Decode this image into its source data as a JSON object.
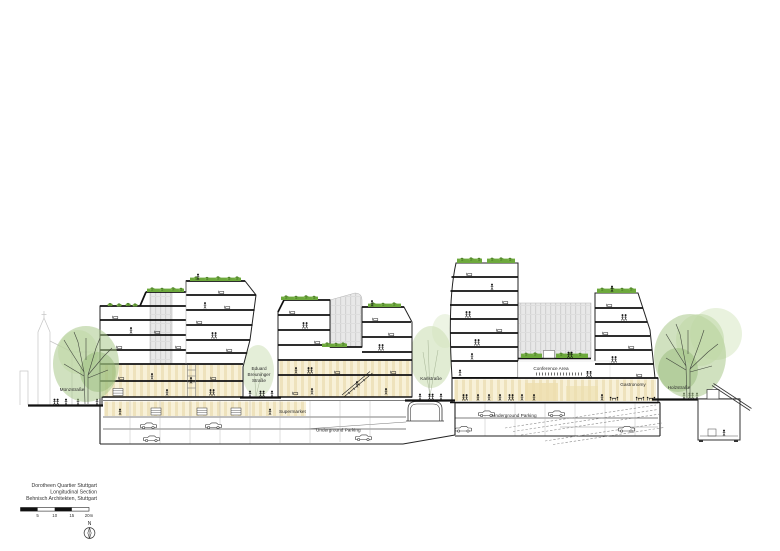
{
  "drawing": {
    "street_labels": {
      "munzstrasse": "Münzstraße",
      "eduard_breuninger_1": "Eduard",
      "eduard_breuninger_2": "Breuninger",
      "eduard_breuninger_3": "Straße",
      "karlstrasse": "Karlstraße",
      "holzstrasse": "Holzstraße"
    },
    "program_labels": {
      "supermarket": "Supermarket",
      "underground_parking_left": "Underground Parking",
      "underground_parking_right": "Underground Parking",
      "conference_area": "Conference Area",
      "gastronomy": "Gastronomy"
    }
  },
  "title_block": {
    "project": "Dorotheen Quartier Stuttgart",
    "drawing_type": "Longitudinal Section",
    "firm": "Behnisch Architekten, Stuttgart"
  },
  "scale_bar": {
    "tick_5": "5",
    "tick_10": "10",
    "tick_15": "15",
    "tick_20": "20m"
  },
  "compass": {
    "north_label": "N"
  },
  "colors": {
    "paper": "#ffffff",
    "ink": "#1c1c1c",
    "beige_fill": "#f8f1d8",
    "beige_stripe": "#eee2bc",
    "terrace_green": "#6da93c",
    "tree_green": "#a9c98b",
    "hatch_gray": "#e7e7e7",
    "silhouette_gray": "#c6c6c6"
  }
}
